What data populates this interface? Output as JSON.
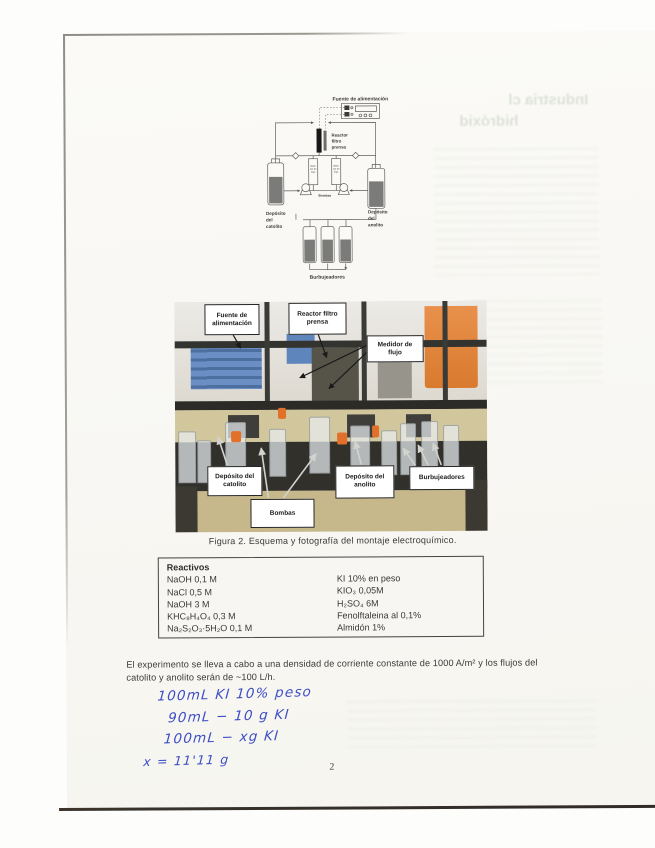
{
  "page": {
    "number": "2"
  },
  "bleedthrough": {
    "line1": "Industria cl",
    "line2": "hidróxid"
  },
  "schematic": {
    "power_label": "Fuente de alimentación",
    "reactor_lines": [
      "Reactor",
      "filtro",
      "prensa"
    ],
    "flowmeter_lines": [
      "Medi-",
      "dor de",
      "flujo"
    ],
    "pumps_label": "Bombas",
    "catholyte_lines": [
      "Depósito",
      "del",
      "catolito"
    ],
    "anolyte_lines": [
      "Depósito",
      "del",
      "anolito"
    ],
    "bubblers_label": "Burbujeadores"
  },
  "photo": {
    "labels": {
      "fuente": {
        "line1": "Fuente de",
        "line2": "alimentación"
      },
      "reactor": {
        "line1": "Reactor filtro",
        "line2": "prensa"
      },
      "medidor": {
        "line1": "Medidor de",
        "line2": "flujo"
      },
      "catolito": {
        "line1": "Depósito del",
        "line2": "catolito"
      },
      "bombas": {
        "line1": "Bombas"
      },
      "anolito": {
        "line1": "Depósito del",
        "line2": "anolito"
      },
      "burbujeadores": {
        "line1": "Burbujeadores"
      }
    }
  },
  "figure": {
    "caption": "Figura 2. Esquema y fotografía del montaje electroquímico."
  },
  "reagents": {
    "title": "Reactivos",
    "left": [
      "NaOH 0,1 M",
      "NaCl 0,5 M",
      "NaOH 3 M",
      "KHC₈H₄O₄ 0,3 M",
      "Na₂S₂O₃·5H₂O 0,1 M"
    ],
    "right": [
      "KI 10% en peso",
      "KIO₃ 0,05M",
      "H₂SO₄ 6M",
      "Fenolftaleina al 0,1%",
      "Almidón 1%"
    ]
  },
  "paragraph": {
    "text": "El experimento se lleva a cabo a una densidad de corriente constante de 1000 A/m² y los flujos del catolito y anolito serán de ~100 L/h."
  },
  "handwriting": {
    "lines": [
      "100mL KI  10% peso",
      "90mL − 10 g KI",
      "100mL − xg KI",
      "x = 11'11 g"
    ]
  }
}
